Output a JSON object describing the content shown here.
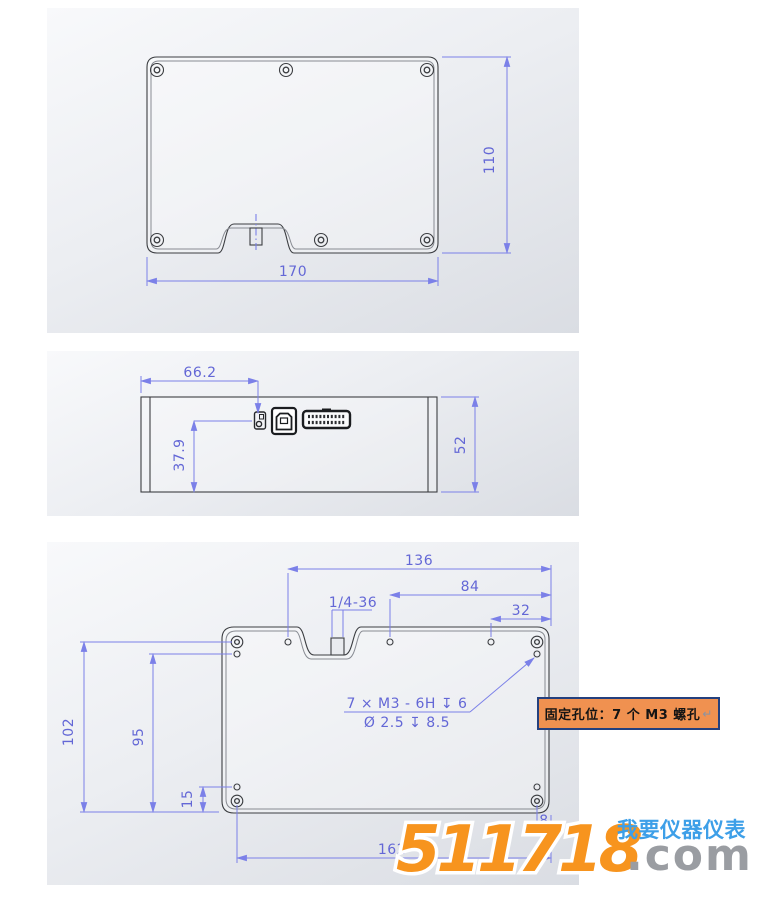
{
  "colors": {
    "dim_line": "#7b80e8",
    "dim_text": "#6367d6",
    "drawing_line": "#3c3e42",
    "inner_line": "#888b92",
    "callout_bg": "#f09150",
    "callout_border": "#24407e",
    "watermark_orange": "#f7941e",
    "watermark_gray": "#9a9da2",
    "watermark_blue": "#3d9fe8"
  },
  "views": {
    "top": {
      "dims": {
        "w": "170",
        "h": "110"
      }
    },
    "side": {
      "dims": {
        "offset": "66.2",
        "drop": "37.9",
        "h": "52"
      }
    },
    "bottom": {
      "dims": {
        "d136": "136",
        "d84": "84",
        "d32": "32",
        "thread": "1/4-36",
        "d102": "102",
        "d95": "95",
        "d15": "15",
        "d8": "8",
        "d162": "162"
      },
      "note1": "7 × M3 - 6H ↧ 6",
      "note2": "Ø 2.5 ↧ 8.5"
    }
  },
  "callout": {
    "text": "固定孔位：7 个 M3 螺孔",
    "return_mark": "↵"
  },
  "watermark": {
    "digits": "511718",
    "tld": ".com",
    "slogan": "我要仪器仪表"
  }
}
